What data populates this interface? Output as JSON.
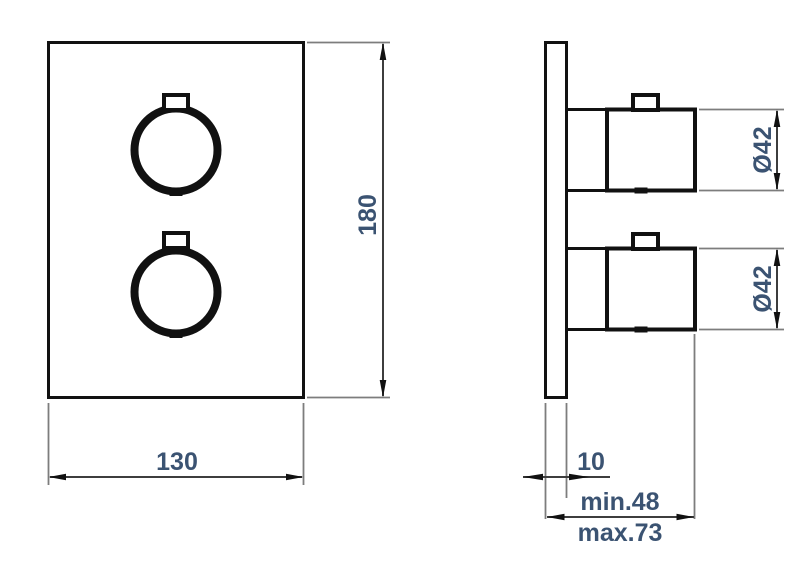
{
  "drawing": {
    "type": "technical-dimension-drawing",
    "subject": "dual-knob-thermostatic-valve-trim",
    "dimensions": {
      "width": "130",
      "height": "180",
      "top_knob_diameter": "Ø42",
      "bottom_knob_diameter": "Ø42",
      "plate_thickness": "10",
      "install_depth_min": "min.48",
      "install_depth_max": "max.73"
    },
    "colors": {
      "outline": "#111111",
      "dim_line": "#3d3d3d",
      "ext_line": "#7d7d7d",
      "text": "#3b5372",
      "background": "#ffffff"
    }
  }
}
